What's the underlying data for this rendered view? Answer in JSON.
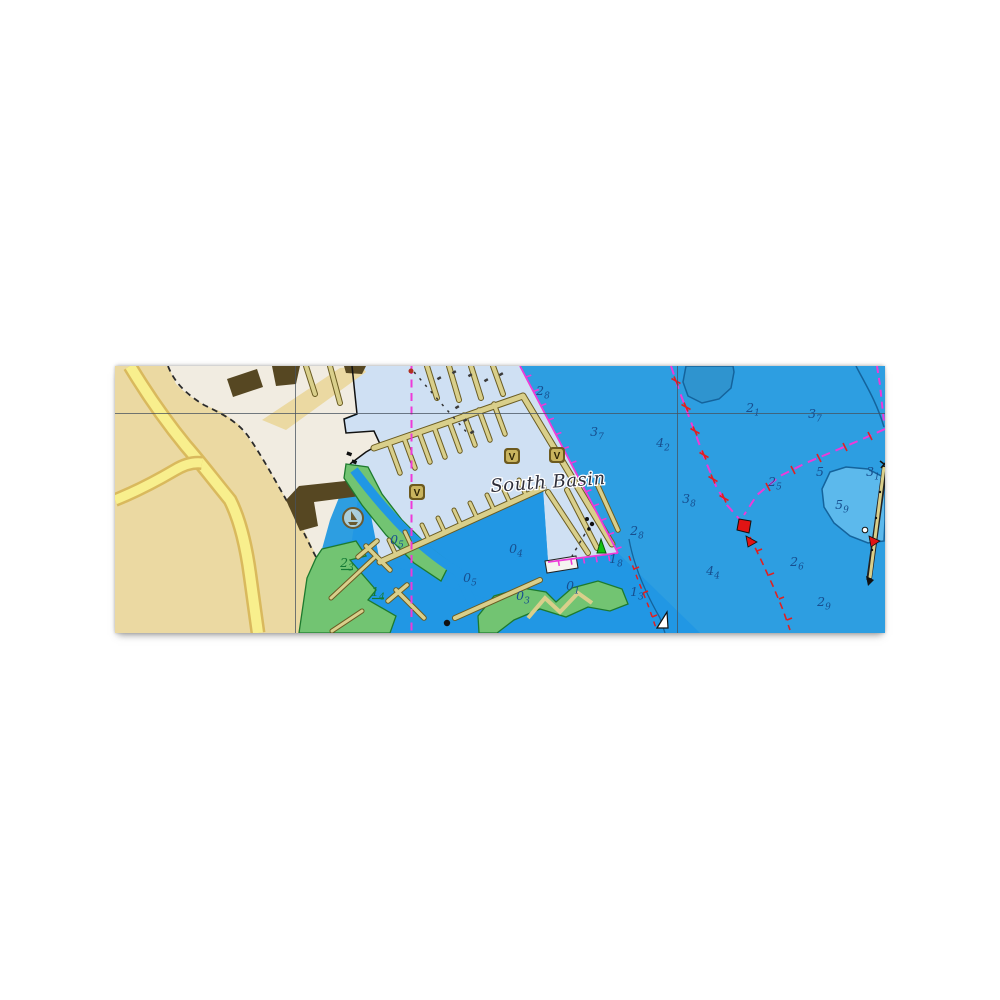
{
  "chart": {
    "basin_label": "South Basin",
    "basin_label_rotation": -4,
    "grid": {
      "vertical_x": [
        295,
        677
      ],
      "horizontal_y": [
        413
      ]
    },
    "soundings": [
      {
        "x": 543,
        "y": 391,
        "d": "2",
        "s": "8"
      },
      {
        "x": 597,
        "y": 432,
        "d": "3",
        "s": "7"
      },
      {
        "x": 753,
        "y": 408,
        "d": "2",
        "s": "1"
      },
      {
        "x": 815,
        "y": 414,
        "d": "3",
        "s": "7"
      },
      {
        "x": 663,
        "y": 443,
        "d": "4",
        "s": "2"
      },
      {
        "x": 689,
        "y": 499,
        "d": "3",
        "s": "8"
      },
      {
        "x": 775,
        "y": 482,
        "d": "2",
        "s": "5"
      },
      {
        "x": 820,
        "y": 472,
        "d": "5",
        "s": ""
      },
      {
        "x": 873,
        "y": 472,
        "d": "3",
        "s": "1"
      },
      {
        "x": 842,
        "y": 505,
        "d": "5",
        "s": "9"
      },
      {
        "x": 637,
        "y": 531,
        "d": "2",
        "s": "8"
      },
      {
        "x": 616,
        "y": 559,
        "d": "1",
        "s": "8"
      },
      {
        "x": 713,
        "y": 571,
        "d": "4",
        "s": "4"
      },
      {
        "x": 797,
        "y": 562,
        "d": "2",
        "s": "6"
      },
      {
        "x": 824,
        "y": 602,
        "d": "2",
        "s": "9"
      },
      {
        "x": 637,
        "y": 592,
        "d": "1",
        "s": "3"
      },
      {
        "x": 516,
        "y": 549,
        "d": "0",
        "s": "4"
      },
      {
        "x": 470,
        "y": 578,
        "d": "0",
        "s": "5"
      },
      {
        "x": 573,
        "y": 586,
        "d": "0",
        "s": "1"
      },
      {
        "x": 397,
        "y": 540,
        "d": "0",
        "s": "5"
      },
      {
        "x": 523,
        "y": 596,
        "d": "0",
        "s": "3"
      }
    ],
    "drying_heights": [
      {
        "x": 347,
        "y": 563,
        "d": "2",
        "s": "3"
      },
      {
        "x": 378,
        "y": 592,
        "d": "1",
        "s": "4"
      }
    ],
    "berth_symbols": {
      "glyph": "V",
      "positions": [
        {
          "x": 512,
          "y": 456
        },
        {
          "x": 557,
          "y": 455
        },
        {
          "x": 417,
          "y": 492
        }
      ]
    },
    "colors": {
      "deep_water": "#2d9ee1",
      "inner_water": "#2197e4",
      "shallow_patch": "#5cb9ec",
      "dark_patch": "#2f94cf",
      "marina_water": "#cfe0f3",
      "land_light": "#f1ece1",
      "land_tan": "#ebd9a2",
      "road_fill": "#f8ef8d",
      "road_casing": "#d9b95d",
      "green_intertidal": "#72c472",
      "green_outline": "#1d7a2e",
      "dock": "#d9cf8b",
      "dock_outline": "#6a5c22",
      "building": "#564722",
      "magenta": "#ee3ad8",
      "hazard_red": "#e02020",
      "sounding_navy": "#174f8f",
      "drying_green": "#157a35",
      "buoy_green": "#12c212",
      "buoy_red": "#e01414",
      "contour_blue": "#14639c",
      "grid_line": "#46525e"
    }
  }
}
